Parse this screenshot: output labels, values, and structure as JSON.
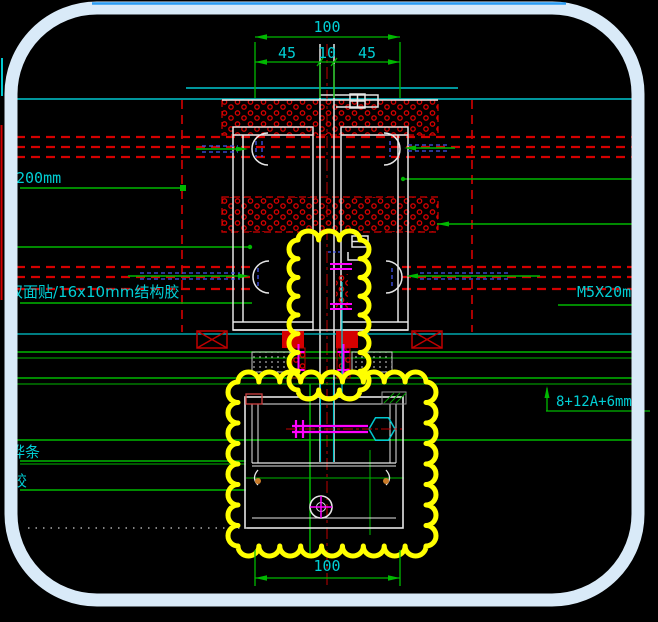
{
  "drawing": {
    "type": "curtain-wall-mullion-section-detail",
    "dimensions": {
      "top_total": "100",
      "top_segments": [
        "45",
        "10",
        "45"
      ],
      "bottom_total": "100"
    },
    "labels": {
      "embed_length": "200mm",
      "structural_sealant": "双面贴/16x10mm结构胶",
      "strip": "桦条",
      "glue": "胶",
      "screw_spec": "M5X20mm",
      "glass_spec": "8+12A+6mm"
    },
    "colors": {
      "background": "#000000",
      "frame": "#d9eaf8",
      "frame_top_line": "#2a9df4",
      "dimension_green": "#00b800",
      "text_cyan": "#00ced4",
      "hatch_red": "#d40000",
      "revision_cloud_yellow": "#ffff00",
      "bolt_magenta": "#ff00ff",
      "gasket_blue": "#4455ee",
      "profile_white": "#e6e6e6"
    }
  }
}
